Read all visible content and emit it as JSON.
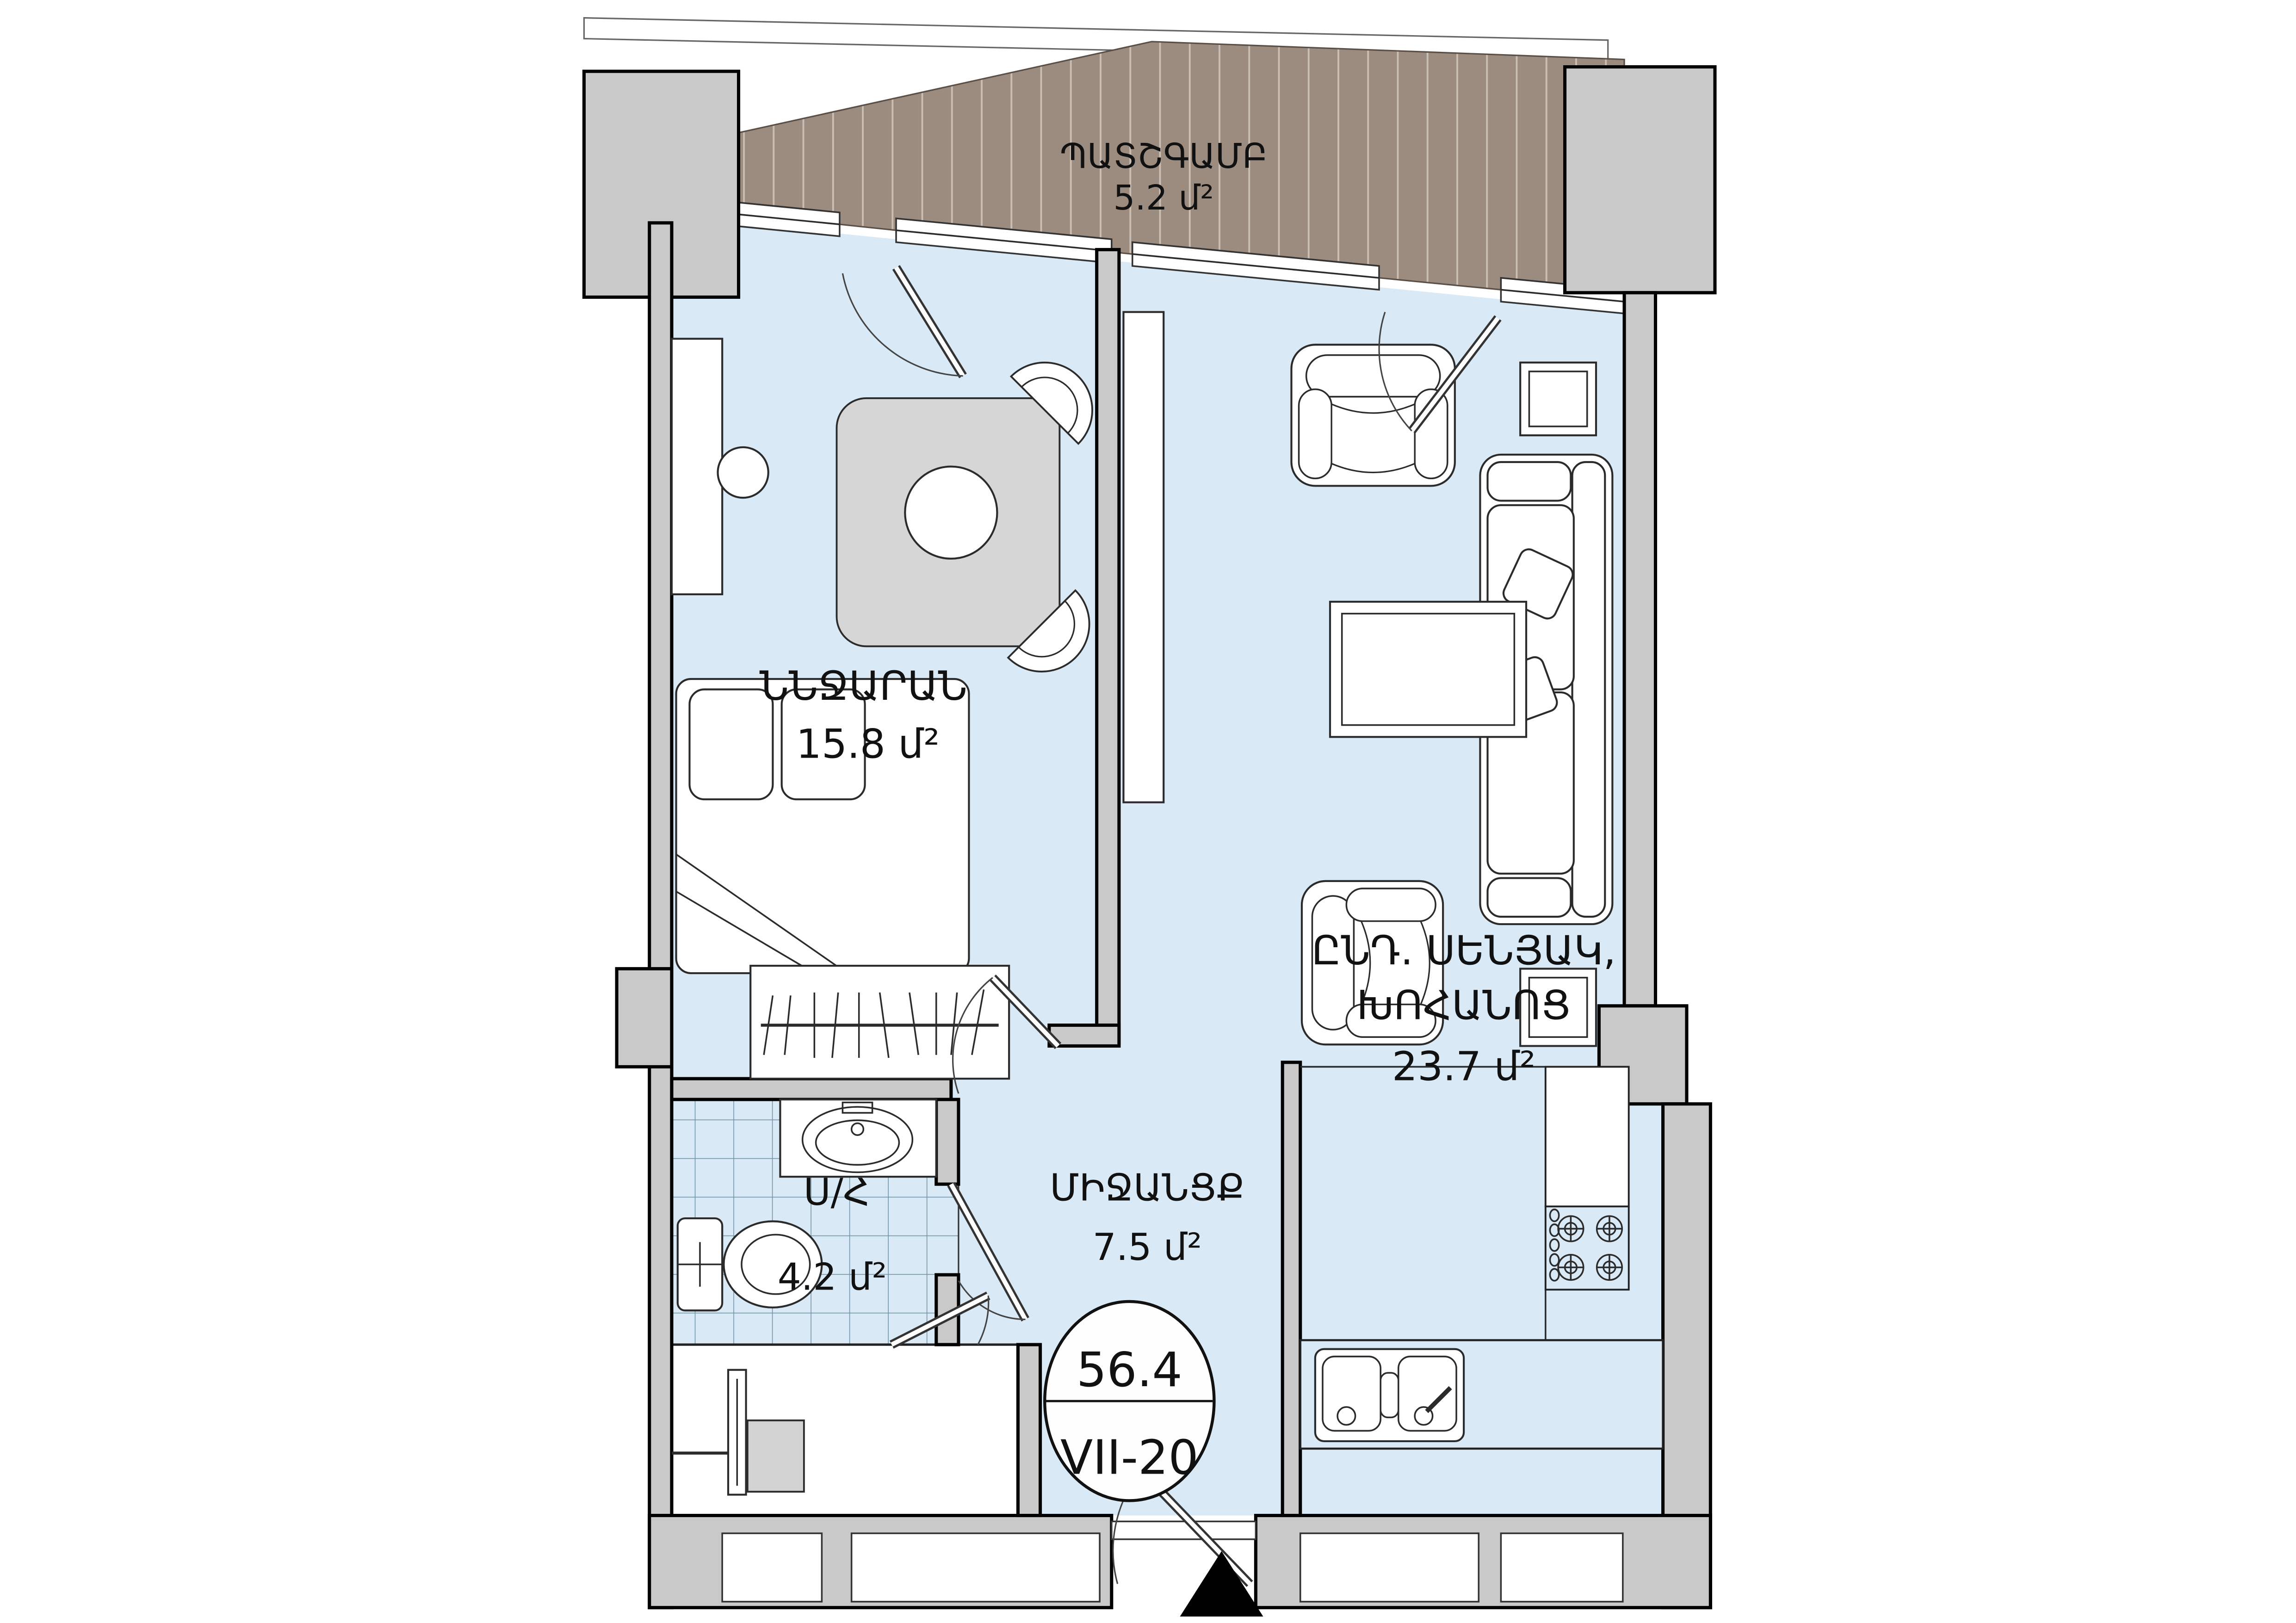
{
  "plan": {
    "unit": {
      "total_area": "56.4",
      "code": "VII-20"
    },
    "balcony": {
      "name": "ՊԱՏՇԳԱՄԲ",
      "area": "5.2 մ²"
    },
    "bedroom": {
      "name": "ՆՆՋԱՐԱՆ",
      "area": "15.8 մ²"
    },
    "living": {
      "name_line1": "ԸՆԴ. ՍԵՆՅԱԿ,",
      "name_line2": "ԽՈՀԱՆՈՑ",
      "area": "23.7 մ²"
    },
    "hallway": {
      "name": "ՄԻՋԱՆՑՔ",
      "area": "7.5 մ²"
    },
    "bathroom": {
      "name": "Ս/Հ",
      "area": "4.2 մ²"
    },
    "colors": {
      "floor": "#d9e9f5",
      "walls": "#c9c9c9",
      "balcony_deck": "#9c8c80",
      "outline": "#000000",
      "furniture": "#ffffff",
      "table": "#d6d6d6"
    },
    "icons": [
      "entrance-triangle-icon",
      "door-swing-icon",
      "stove-burner-icon",
      "sink-icon",
      "shower-icon",
      "toilet-icon",
      "hanger-rail-icon"
    ]
  }
}
